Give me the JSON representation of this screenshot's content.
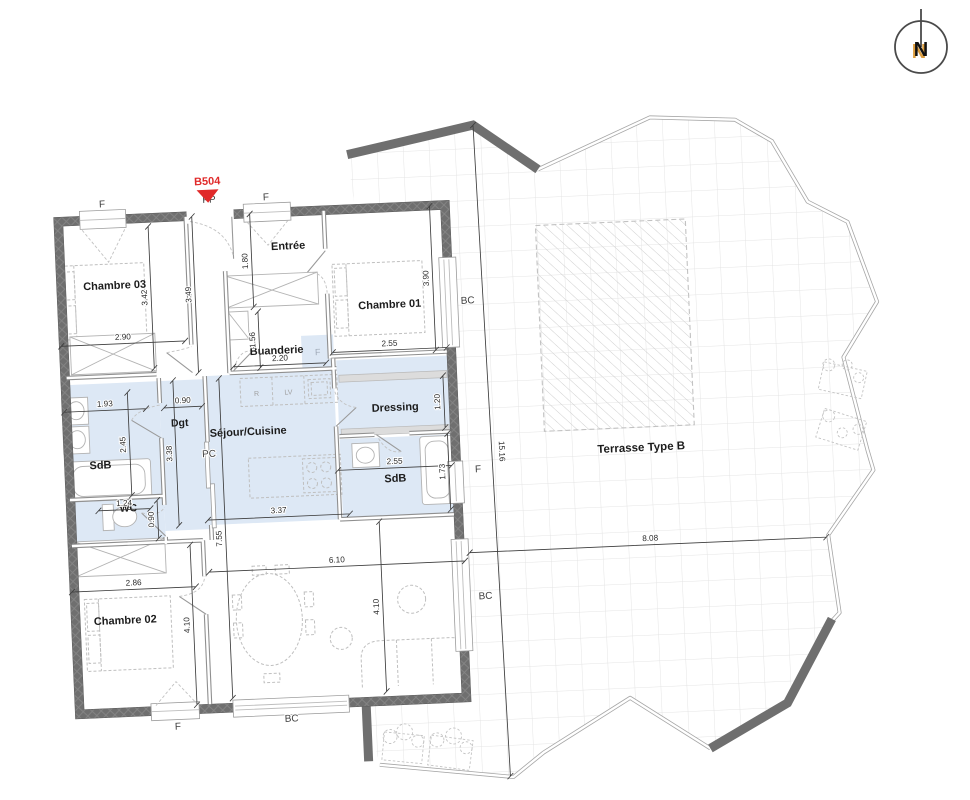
{
  "plan": {
    "unit_marker": "B504",
    "north_label": "N",
    "rooms": {
      "chambre03": "Chambre 03",
      "entree": "Entrée",
      "chambre01": "Chambre 01",
      "buanderie": "Buanderie",
      "dressing": "Dressing",
      "dgt": "Dgt",
      "sdb1": "SdB",
      "wc": "WC",
      "sejour": "Séjour/Cuisine",
      "sdb2": "SdB",
      "chambre02": "Chambre 02",
      "terrasse": "Terrasse Type B"
    },
    "openings": {
      "pp": "PP",
      "f": "F",
      "bc": "BC",
      "pc": "PC"
    },
    "appliances": {
      "fridge": "R",
      "dishwasher": "LV",
      "shaft": "F"
    },
    "dimensions": {
      "ch03_width": "2.90",
      "ch03_length": "3.42",
      "hall_length": "3.49",
      "entree_length": "1.80",
      "buanderie_length": "1.56",
      "buanderie_width": "2.20",
      "ch01_width": "2.55",
      "ch01_length": "3.90",
      "dressing_length": "1.20",
      "sdb2_width": "2.55",
      "sdb2_length": "1.73",
      "sdb1_width": "1.93",
      "dgt_width": "0.90",
      "sdb1_length": "2.45",
      "dgt_length": "3.38",
      "wc_width": "1.24",
      "wc_length": "0.90",
      "kitchen_width": "3.37",
      "sejour_length": "7.55",
      "sejour_width": "6.10",
      "ch02_width": "2.86",
      "ch02_length": "4.10",
      "salon_length": "4.10",
      "terrace_width": "8.08",
      "terrace_length": "15.16"
    },
    "colors": {
      "wall": "#6f6f6f",
      "floor_blue": "#dde8f5",
      "marker_red": "#e02a2a",
      "tile_line": "#e4e4e4",
      "boundary": "#a6a6a6",
      "furniture": "#bfbfbf"
    }
  }
}
